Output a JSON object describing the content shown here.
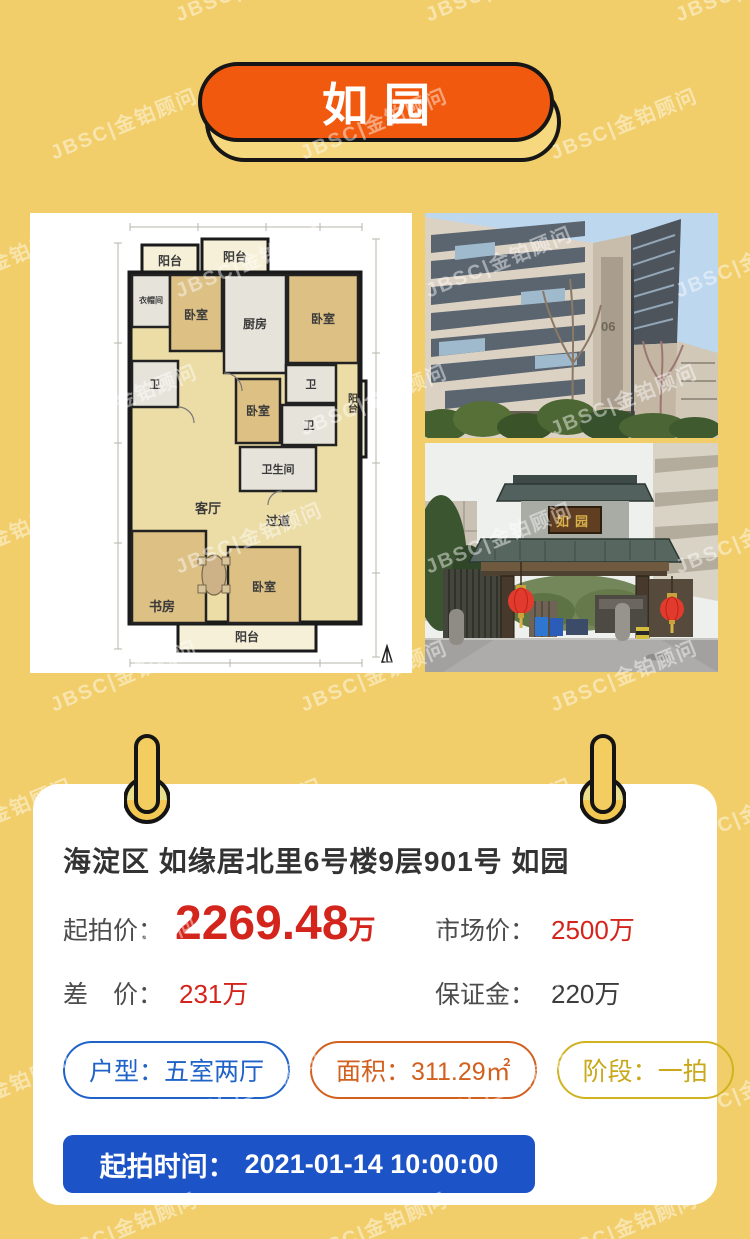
{
  "watermark": {
    "text": "JBSC|金铂顾问"
  },
  "badge": {
    "title": "如园"
  },
  "media": {
    "floorplan": {
      "rooms": [
        "阳台",
        "阳台",
        "衣帽间",
        "卧室",
        "厨房",
        "卧室",
        "卫",
        "卫",
        "卫",
        "阳台",
        "卧室",
        "卫生间",
        "客厅",
        "过道",
        "书房",
        "卧室",
        "阳台"
      ]
    },
    "photo_building": {
      "building_number": "06"
    },
    "photo_gate": {
      "plaque": "如园"
    }
  },
  "card": {
    "title": "海淀区 如缘居北里6号楼9层901号 如园",
    "start_price": {
      "label": "起拍价：",
      "value": "2269.48",
      "unit": "万"
    },
    "market_price": {
      "label": "市场价：",
      "value": "2500万"
    },
    "price_diff": {
      "label": "差　价：",
      "value": "231万"
    },
    "deposit": {
      "label": "保证金：",
      "value": "220万"
    },
    "tags": [
      {
        "label": "户型：",
        "value": "五室两厅"
      },
      {
        "label": "面积：",
        "value": "311.29㎡"
      },
      {
        "label": "阶段：",
        "value": "一拍"
      }
    ],
    "start_time": {
      "label": "起拍时间：",
      "value": "2021-01-14 10:00:00"
    }
  },
  "colors": {
    "background": "#F2CE6A",
    "badge_orange": "#F15A0E",
    "price_red": "#D4251C",
    "tag_blue": "#2063C8",
    "tag_orange": "#D2601F",
    "tag_gold": "#D0B320",
    "button_blue": "#1C53C6"
  }
}
